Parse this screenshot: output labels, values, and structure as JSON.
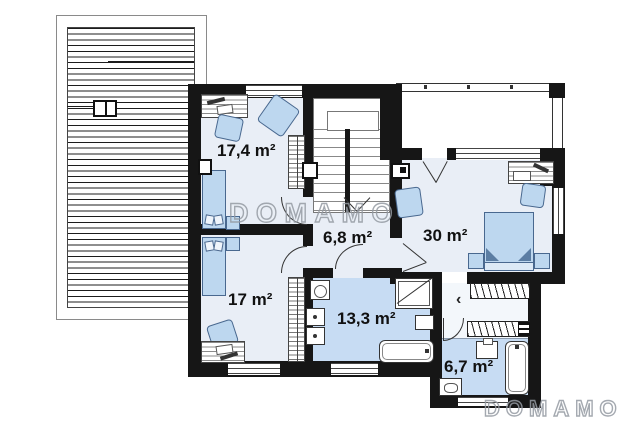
{
  "plan": {
    "title_hint": "second floor plan",
    "rooms": [
      {
        "name": "room-upper-left",
        "area_label": "17,4 m²"
      },
      {
        "name": "hall",
        "area_label": "6,8 m²"
      },
      {
        "name": "room-master",
        "area_label": "30 m²"
      },
      {
        "name": "room-lower-left",
        "area_label": "17 m²"
      },
      {
        "name": "bathroom-main",
        "area_label": "13,3 m²"
      },
      {
        "name": "bathroom-ensuite",
        "area_label": "6,7 m²"
      }
    ],
    "closet_arrow": "‹"
  },
  "watermark": {
    "text": "DOMAMO"
  },
  "colors": {
    "wall": "#161616",
    "room_floor": "#e9eef6",
    "bath_floor": "#c7dcf3",
    "closet_floor": "#f3f7fb",
    "furniture_fill": "#bdd7ef",
    "furniture_outline": "#49688f",
    "watermark_gray": "#949aa2"
  }
}
